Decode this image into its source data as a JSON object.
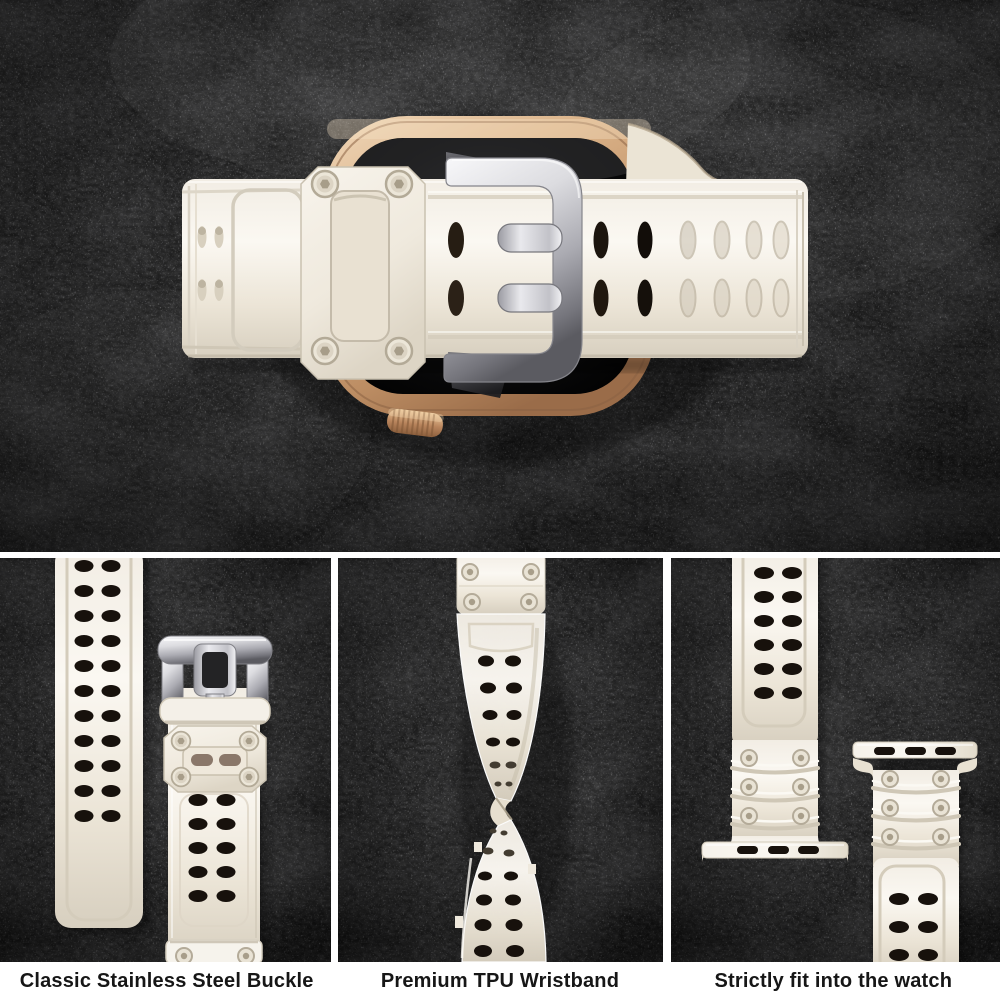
{
  "image": {
    "subject": "Top view of a smartwatch with gold case fitted with an off-white rugged TPU strap and a stainless steel buckle, photographed on dark slate",
    "sections": [
      "hero-photo",
      "buckle-closeup",
      "wristband-twist",
      "watch-fit"
    ]
  },
  "panels": [
    {
      "name": "buckle-closeup",
      "caption": "Classic Stainless Steel Buckle"
    },
    {
      "name": "wristband-twist",
      "caption": "Premium TPU Wristband"
    },
    {
      "name": "watch-fit",
      "caption": "Strictly fit into the watch"
    }
  ],
  "colors": {
    "background_slate": "#161616",
    "band_cream": "#f2eee5",
    "band_shadow": "#d6cebe",
    "keeper_screw_ring": "#b3aa97",
    "buckle_silver": "#d9d9dd",
    "prong_silver": "#c9c9cf",
    "watch_case_gold": "#c89e74",
    "watch_screen_black": "#0b0b0c",
    "hole_dark": "#17110c",
    "caption_text": "#161616",
    "caption_background": "#ffffff",
    "divider_white": "#ffffff"
  }
}
